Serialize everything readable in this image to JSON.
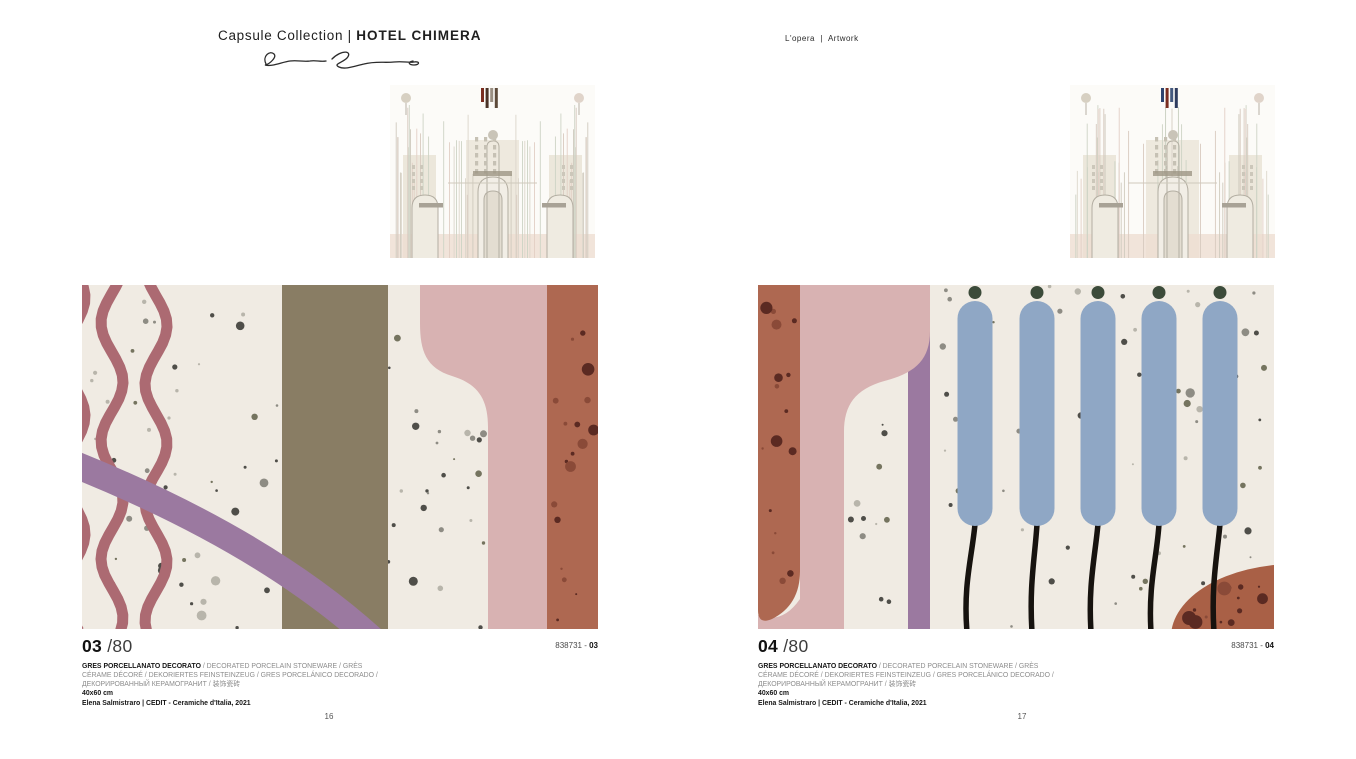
{
  "header": {
    "collection_regular": "Capsule Collection | ",
    "collection_bold": "HOTEL CHIMERA",
    "section_label": "L'opera  |  Artwork"
  },
  "description": {
    "bold": "GRES PORCELLANATO DECORATO",
    "line1_rest": " / DECORATED PORCELAIN STONEWARE / GRÈS",
    "line2": "CÉRAME DÉCORÉ / DEKORIERTES FEINSTEINZEUG / GRES PORCELÁNICO DECORADO /",
    "line3": "ДЕКОРИРОВАННЫЙ КЕРАМОГРАНИТ / 装饰瓷砖",
    "size": "40x60 cm",
    "credit": "Elena Salmistraro | CEDIT - Ceramiche d'Italia, 2021"
  },
  "pages": {
    "left": {
      "index_bold": "03",
      "index_total": "/80",
      "code_prefix": "838731 - ",
      "code_bold": "03",
      "page_number": "16"
    },
    "right": {
      "index_bold": "04",
      "index_total": "/80",
      "code_prefix": "838731 - ",
      "code_bold": "04",
      "page_number": "17"
    }
  },
  "colors": {
    "cream": "#f0ebe3",
    "rose_wave": "#ac6a72",
    "purple": "#9b79a0",
    "olive": "#897d64",
    "pink": "#d8b2b2",
    "terracotta": "#ae6851",
    "terracotta_dark": "#5b2a22",
    "terracotta_mid": "#8a4a38",
    "dome": "#a96046",
    "blue_capsule": "#8fa7c5",
    "dark_green": "#3c4b3a",
    "stem_black": "#17130f",
    "speckle_dark": "#4f4e49",
    "speckle_mid": "#8e8c84",
    "speckle_olive": "#75745f",
    "speckle_light": "#b8b5ab"
  },
  "thumbnails": {
    "left_accent_bars": [
      "#7a2d20",
      "#4a3226",
      "#9a8f83",
      "#5d4a3a"
    ],
    "right_accent_bars": [
      "#2e4570",
      "#7a2d20",
      "#44597f",
      "#2e3b5e"
    ]
  }
}
